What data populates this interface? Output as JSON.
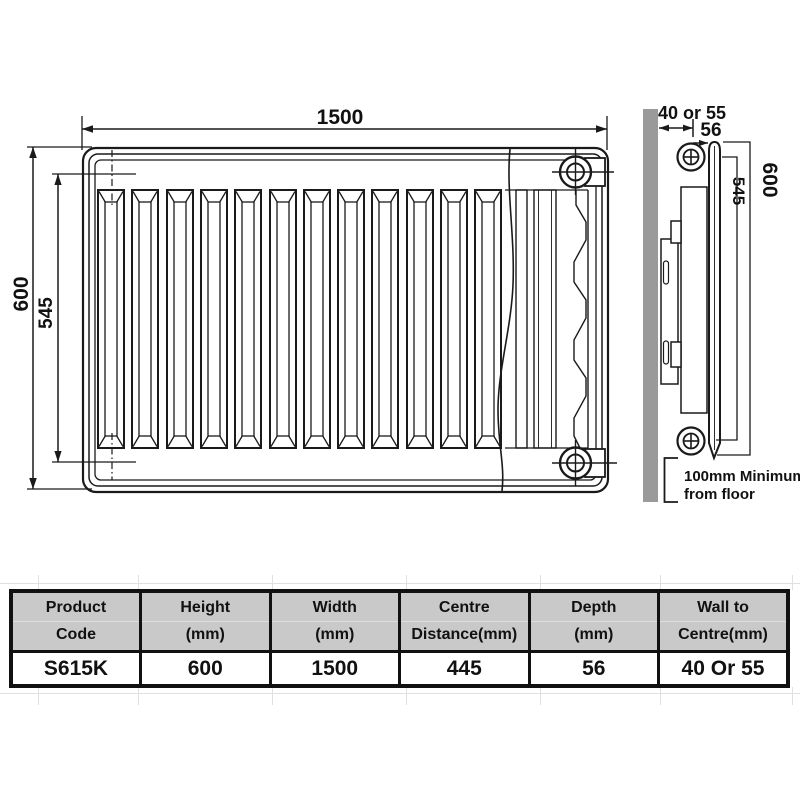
{
  "diagram": {
    "front_view": {
      "width_label": "1500",
      "height_label": "600",
      "centre_height_label": "545"
    },
    "side_view": {
      "wall_to_centre_label": "40 or 55",
      "depth_label": "56",
      "height_label": "600",
      "centre_height_label": "545",
      "floor_clearance_line1": "100mm Minimum",
      "floor_clearance_line2": "from floor"
    },
    "colors": {
      "line": "#1a1a1a",
      "wall_fill": "#9a9a9a",
      "table_header_bg": "#c9c9c9",
      "table_border": "#111111",
      "gridline": "#e0e0e0"
    }
  },
  "spec_table": {
    "columns": [
      {
        "line1": "Product",
        "line2": "Code"
      },
      {
        "line1": "Height",
        "line2": "(mm)"
      },
      {
        "line1": "Width",
        "line2": "(mm)"
      },
      {
        "line1": "Centre",
        "line2": "Distance(mm)"
      },
      {
        "line1": "Depth",
        "line2": "(mm)"
      },
      {
        "line1": "Wall to",
        "line2": "Centre(mm)"
      }
    ],
    "row": {
      "product_code": "S615K",
      "height": "600",
      "width": "1500",
      "centre_distance": "445",
      "depth": "56",
      "wall_to_centre": "40 Or 55"
    }
  }
}
